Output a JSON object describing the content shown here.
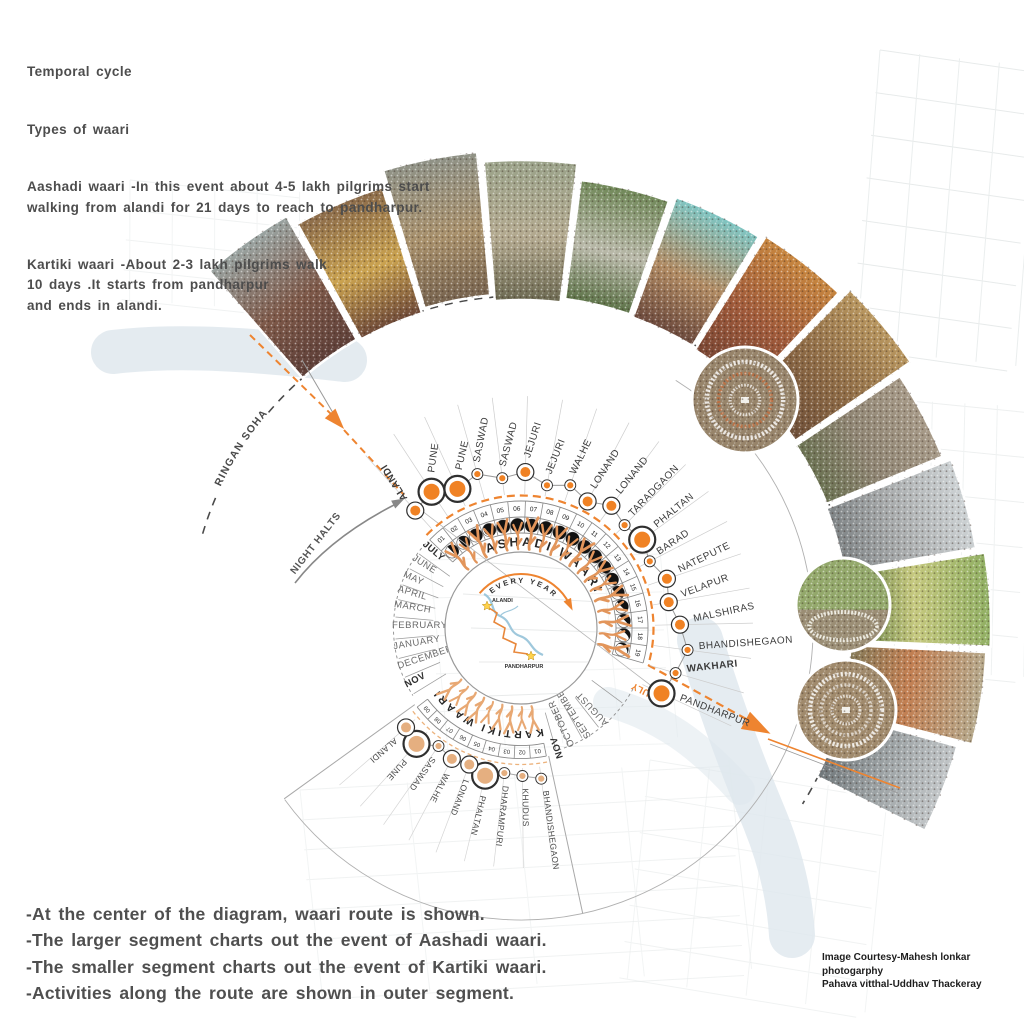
{
  "header": {
    "title1": "Temporal cycle",
    "title2": "Types of waari",
    "para1": "Aashadi  waari -In this event about 4-5 lakh pilgrims start\nwalking from alandi for 21 days to reach to pandharpur.",
    "para2": "Kartiki waari -About 2-3 lakh pilgrims walk\n10 days .It starts from pandharpur\nand ends in alandi."
  },
  "footer": {
    "notes": "-At the center of the diagram, waari route is shown.\n-The larger segment charts out the event of Aashadi waari.\n-The smaller segment charts out the event of Kartiki waari.\n-Activities along the route are shown in outer segment."
  },
  "credits": "Image Courtesy-Mahesh lonkar\nphotogarphy\nPahava vitthal-Uddhav Thackeray",
  "colors": {
    "accent_orange": "#EE8430",
    "dot_orange": "#F08224",
    "kartiki_dot": "#E5AF80",
    "pilgrim": "#E2955B",
    "river": "#DFE7ED",
    "ink": "#4d4d4d"
  },
  "diagram": {
    "center_labels": {
      "every_year": "EVERY YEAR",
      "alandi": "ALANDI",
      "pandharpur": "PANDHARPUR"
    },
    "annotations": {
      "ringan": "RINGAN SOHALA",
      "night_halts": "NIGHT HALTS"
    },
    "months": [
      {
        "label": "JULY",
        "angle": 140,
        "bold": true
      },
      {
        "label": "JUNE",
        "angle": 148
      },
      {
        "label": "MAY",
        "angle": 156.5
      },
      {
        "label": "APRIL",
        "angle": 163.5
      },
      {
        "label": "MARCH",
        "angle": 170.5
      },
      {
        "label": "FEBRUARY",
        "angle": 180
      },
      {
        "label": "JANUARY",
        "angle": 189.5
      },
      {
        "label": "DECEMBER",
        "angle": 198.5
      },
      {
        "label": "NOV",
        "angle": 207.5,
        "bold": true
      },
      {
        "label": "NOV",
        "angle": -72,
        "bold": true,
        "r": 136
      },
      {
        "label": "OCTOBER",
        "angle": -65.5
      },
      {
        "label": "SEPTEMBER",
        "angle": -57
      },
      {
        "label": "AUGUST",
        "angle": -47
      },
      {
        "label": "JULY",
        "angle": -26,
        "bold": true,
        "accent": true,
        "r": 150
      }
    ],
    "ashadi": {
      "title": "ASHADI WAARI",
      "days": [
        {
          "d": "01",
          "moon": 0.5
        },
        {
          "d": "02",
          "moon": 0.66
        },
        {
          "d": "03",
          "moon": 0.78
        },
        {
          "d": "04",
          "moon": 0.88
        },
        {
          "d": "05",
          "moon": 0.97
        },
        {
          "d": "06",
          "moon": 1
        },
        {
          "d": "07",
          "moon": 1
        },
        {
          "d": "08",
          "moon": 1
        },
        {
          "d": "09",
          "moon": 1
        },
        {
          "d": "10",
          "moon": 1
        },
        {
          "d": "11",
          "moon": 1
        },
        {
          "d": "12",
          "moon": 0.96
        },
        {
          "d": "13",
          "moon": 0.88
        },
        {
          "d": "14",
          "moon": 0.78
        },
        {
          "d": "15",
          "moon": 0.66
        },
        {
          "d": "16",
          "moon": 0.52
        },
        {
          "d": "17",
          "moon": 0.42
        },
        {
          "d": "18",
          "moon": 0.3
        },
        {
          "d": "19",
          "moon": 0.18
        }
      ],
      "stops": [
        {
          "name": "ALANDI",
          "size": "M",
          "rot": -122,
          "bold": true,
          "r": 158
        },
        {
          "name": "PUNE",
          "size": "L",
          "rot": -82,
          "r": 163
        },
        {
          "name": "PUNE",
          "size": "L",
          "rot": -77,
          "r": 153
        },
        {
          "name": "SASWAD",
          "size": "S",
          "rot": -79,
          "r": 160
        },
        {
          "name": "SASWAD",
          "size": "S",
          "rot": -75,
          "r": 151
        },
        {
          "name": "JEJURI",
          "size": "M",
          "rot": -72,
          "r": 156
        },
        {
          "name": "JEJURI",
          "size": "S",
          "rot": -68,
          "r": 145
        },
        {
          "name": "WALHE",
          "size": "S",
          "rot": -64,
          "r": 151
        },
        {
          "name": "LONAND",
          "size": "M",
          "rot": -57,
          "r": 143
        },
        {
          "name": "LONAND",
          "size": "M",
          "rot": -51,
          "r": 152
        },
        {
          "name": "TARADGAON",
          "size": "S",
          "rot": -46,
          "r": 146
        },
        {
          "name": "PHALTAN",
          "size": "L",
          "rot": -39,
          "r": 150
        },
        {
          "name": "BARAD",
          "size": "S",
          "rot": -34,
          "r": 145
        },
        {
          "name": "NATEPUTE",
          "size": "M",
          "rot": -26,
          "r": 154
        },
        {
          "name": "VELAPUR",
          "size": "M",
          "rot": -20,
          "r": 150
        },
        {
          "name": "MALSHIRAS",
          "size": "M",
          "rot": -12,
          "r": 159
        },
        {
          "name": "BHANDISHEGAON",
          "size": "S",
          "rot": -4,
          "r": 168
        },
        {
          "name": "WAKHARI",
          "size": "S",
          "rot": -6,
          "bold": true,
          "r": 161
        },
        {
          "name": "PANDHARPUR",
          "size": "L",
          "rot": 21,
          "r": 155
        }
      ]
    },
    "kartiki": {
      "title": "KARTIKI WAARI",
      "days": [
        "01",
        "02",
        "03",
        "04",
        "05",
        "06",
        "07",
        "08",
        "09"
      ],
      "stops": [
        {
          "name": "BHANDISHEGAON",
          "size": "S",
          "r": 152
        },
        {
          "name": "KHUDUS",
          "size": "S",
          "r": 148
        },
        {
          "name": "DHARAMPURI",
          "size": "S",
          "r": 146
        },
        {
          "name": "PHALTAN",
          "size": "L",
          "r": 152
        },
        {
          "name": "LONAND",
          "size": "M",
          "r": 146
        },
        {
          "name": "WALHE",
          "size": "M",
          "r": 148
        },
        {
          "name": "SASWAD",
          "size": "S",
          "r": 144
        },
        {
          "name": "PUNE",
          "size": "L",
          "r": 156
        },
        {
          "name": "ALANDI",
          "size": "M",
          "r": 152
        }
      ]
    },
    "photos": [
      {
        "desc": "riverside ghat crowd",
        "colors": [
          "#9aa5a3",
          "#7d5848",
          "#5e3f38"
        ]
      },
      {
        "desc": "palkhi procession golden decorations",
        "colors": [
          "#8a6a4a",
          "#caa24f",
          "#6f4a38"
        ]
      },
      {
        "desc": "aerial hillside pilgrim trail",
        "colors": [
          "#8f9287",
          "#a8906b",
          "#77634e"
        ]
      },
      {
        "desc": "hill slope crowd aerial",
        "colors": [
          "#9aa289",
          "#b3a98f",
          "#6d6a52"
        ]
      },
      {
        "desc": "green trees and road procession",
        "colors": [
          "#6f8757",
          "#b8b8a8",
          "#5d7348"
        ]
      },
      {
        "desc": "crowd with turquoise canopy",
        "colors": [
          "#7ec6c4",
          "#b08a62",
          "#6d4a3d"
        ]
      },
      {
        "desc": "saffron flags procession",
        "colors": [
          "#c8873f",
          "#a05a3a",
          "#7a4633"
        ]
      },
      {
        "desc": "decorated horse riders",
        "colors": [
          "#b9975f",
          "#8d6a45",
          "#6f4f38"
        ]
      },
      {
        "desc": "village square crowd aerial",
        "colors": [
          "#a79a88",
          "#8f8573",
          "#6b7252"
        ]
      },
      {
        "desc": "white-clad dindi procession",
        "colors": [
          "#cdd2d4",
          "#a8abac",
          "#7f8486"
        ]
      },
      {
        "desc": "ringan formation in green field",
        "colors": [
          "#8fae62",
          "#c5c87e",
          "#5f7a42"
        ]
      },
      {
        "desc": "oval ringan colorful crowd",
        "colors": [
          "#b5a98c",
          "#c27f52",
          "#857a58"
        ]
      },
      {
        "desc": "grey riverbank crowd",
        "colors": [
          "#c2c6c8",
          "#9aa0a2",
          "#70777a"
        ]
      }
    ],
    "photo_circles": [
      {
        "desc": "ringan ceremony aerial",
        "cx": 745,
        "cy": 400,
        "r": 53
      },
      {
        "desc": "ringan in open fields",
        "cx": 843,
        "cy": 605,
        "r": 47
      },
      {
        "desc": "grand circular ringan aerial",
        "cx": 846,
        "cy": 710,
        "r": 50
      }
    ]
  }
}
